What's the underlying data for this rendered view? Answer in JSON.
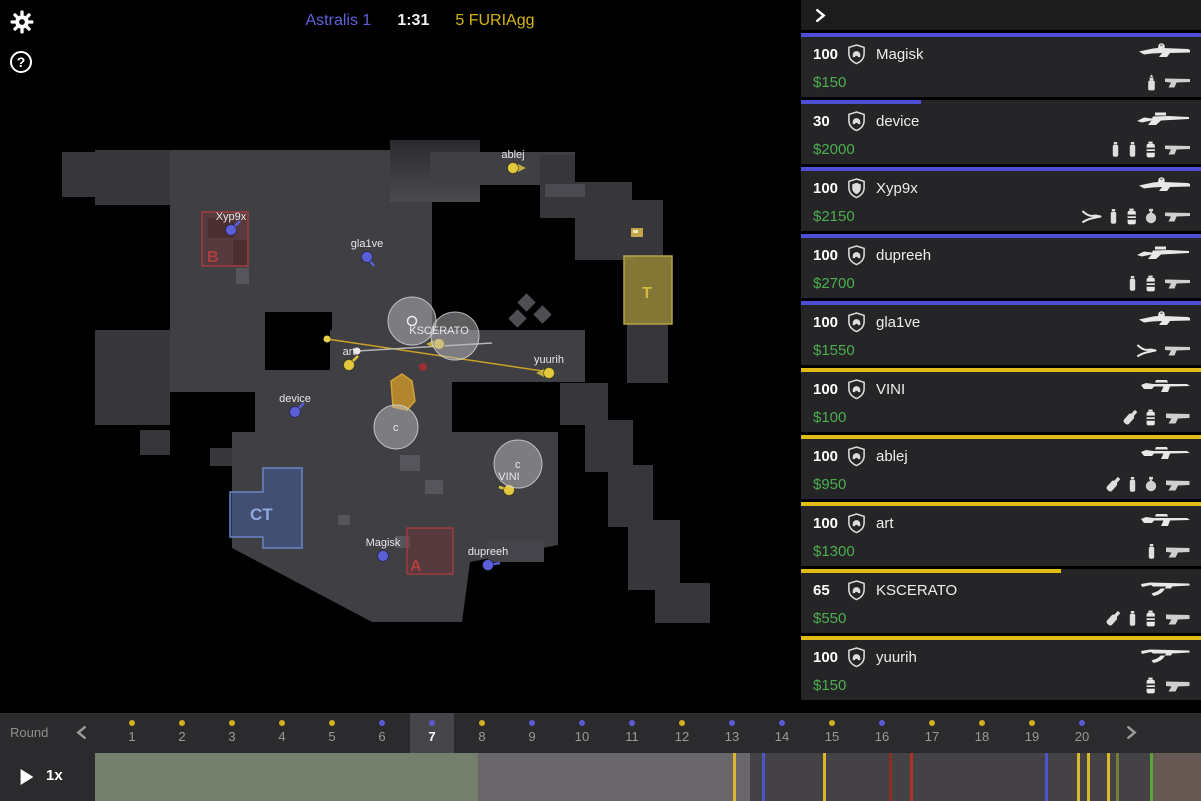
{
  "topbar": {
    "help_glyph": "?"
  },
  "scoreboard": {
    "team1": "Astralis",
    "team1_score": "1",
    "clock": "1:31",
    "team2_score": "5",
    "team2": "FURIAgg"
  },
  "colors": {
    "ct": "#4d4fd4",
    "t": "#e0bd16",
    "map_ct": "#5a5fd8",
    "map_t": "#e3c83f",
    "money": "#4cae4f",
    "dot_ct": "#5b5bd8",
    "dot_t": "#d4af1f"
  },
  "sidebar": {
    "players": [
      {
        "hp": "100",
        "name": "Magisk",
        "money": "$150",
        "team": "ct",
        "armor": "helmet",
        "primary": "aug",
        "items": [
          "incendiary",
          "usp"
        ]
      },
      {
        "hp": "30",
        "name": "device",
        "money": "$2000",
        "team": "ct",
        "armor": "helmet",
        "primary": "awp",
        "items": [
          "flash",
          "flash",
          "smoke",
          "usp"
        ]
      },
      {
        "hp": "100",
        "name": "Xyp9x",
        "money": "$2150",
        "team": "ct",
        "armor": "kevlar",
        "primary": "aug",
        "items": [
          "defuse",
          "flash",
          "smoke",
          "he",
          "usp"
        ]
      },
      {
        "hp": "100",
        "name": "dupreeh",
        "money": "$2700",
        "team": "ct",
        "armor": "helmet",
        "primary": "awp",
        "items": [
          "flash",
          "smoke",
          "usp"
        ]
      },
      {
        "hp": "100",
        "name": "gla1ve",
        "money": "$1550",
        "team": "ct",
        "armor": "helmet",
        "primary": "aug",
        "items": [
          "defuse",
          "usp"
        ]
      },
      {
        "hp": "100",
        "name": "VINI",
        "money": "$100",
        "team": "t",
        "armor": "helmet",
        "primary": "galil",
        "items": [
          "molotov",
          "smoke",
          "glock"
        ]
      },
      {
        "hp": "100",
        "name": "ablej",
        "money": "$950",
        "team": "t",
        "armor": "helmet",
        "primary": "galil",
        "items": [
          "molotov",
          "flash",
          "he",
          "glock"
        ]
      },
      {
        "hp": "100",
        "name": "art",
        "money": "$1300",
        "team": "t",
        "armor": "helmet",
        "primary": "galil",
        "items": [
          "flash",
          "glock"
        ]
      },
      {
        "hp": "65",
        "name": "KSCERATO",
        "money": "$550",
        "team": "t",
        "armor": "helmet",
        "primary": "ak47",
        "items": [
          "molotov",
          "flash",
          "smoke",
          "glock"
        ]
      },
      {
        "hp": "100",
        "name": "yuurih",
        "money": "$150",
        "team": "t",
        "armor": "helmet",
        "primary": "ak47",
        "items": [
          "smoke",
          "glock"
        ]
      }
    ]
  },
  "map": {
    "zones": [
      {
        "id": "b-site",
        "label": "B",
        "shape": "rect",
        "x": 202,
        "y": 212,
        "w": 46,
        "h": 54,
        "label_x": 207,
        "label_y": 262,
        "label_color": "#b04040"
      },
      {
        "id": "a-site",
        "label": "A",
        "shape": "rect",
        "x": 407,
        "y": 528,
        "w": 46,
        "h": 46,
        "label_x": 410,
        "label_y": 571,
        "label_color": "#b04040"
      },
      {
        "id": "ct-spawn",
        "label": "CT",
        "shape": "poly",
        "pts": "230,492 263,492 263,468 302,468 302,548 263,548 263,537 230,537",
        "label_x": 250,
        "label_y": 520,
        "label_color": "#8fa8e0"
      },
      {
        "id": "t-spawn",
        "label": "T",
        "shape": "rect",
        "x": 624,
        "y": 256,
        "w": 48,
        "h": 68,
        "label_x": 642,
        "label_y": 298,
        "label_color": "#d2ba45"
      }
    ],
    "players": [
      {
        "name": "ablej",
        "team": "t",
        "x": 513,
        "y": 168,
        "dir": "cone-right"
      },
      {
        "name": "Xyp9x",
        "team": "ct",
        "x": 231,
        "y": 230,
        "dir": "line-ur"
      },
      {
        "name": "gla1ve",
        "team": "ct",
        "x": 367,
        "y": 257,
        "dir": "line-dr"
      },
      {
        "name": "device",
        "team": "ct",
        "x": 295,
        "y": 412,
        "dir": "line-ur"
      },
      {
        "name": "art",
        "team": "t",
        "x": 349,
        "y": 365,
        "dir": "line-ur"
      },
      {
        "name": "KSCERATO",
        "team": "t",
        "x": 439,
        "y": 344,
        "dir": "cone-left"
      },
      {
        "name": "yuurih",
        "team": "t",
        "x": 549,
        "y": 373,
        "dir": "cone-left"
      },
      {
        "name": "VINI",
        "team": "t",
        "x": 509,
        "y": 490,
        "dir": "line-l"
      },
      {
        "name": "Magisk",
        "team": "ct",
        "x": 383,
        "y": 556,
        "dir": "none"
      },
      {
        "name": "dupreeh",
        "team": "ct",
        "x": 488,
        "y": 565,
        "dir": "line-r"
      }
    ],
    "smokes": [
      {
        "x": 412,
        "y": 321,
        "r": 24,
        "glyph": "o"
      },
      {
        "x": 455,
        "y": 336,
        "r": 24,
        "glyph": ""
      },
      {
        "x": 396,
        "y": 427,
        "r": 22,
        "glyph": "c"
      },
      {
        "x": 518,
        "y": 464,
        "r": 24,
        "glyph": "c"
      }
    ],
    "tracers": [
      {
        "x1": 327,
        "y1": 339,
        "x2": 549,
        "y2": 372,
        "color": "#c9a227",
        "dot": "#e7cf4a"
      },
      {
        "x1": 357,
        "y1": 351,
        "x2": 492,
        "y2": 343,
        "color": "#b5b5b5",
        "dot": "#e8e8e8"
      }
    ],
    "fire": {
      "pts": "391,381 402,374 412,381 415,401 407,410 393,407"
    },
    "red_dot": {
      "x": 423,
      "y": 367
    },
    "bomb": {
      "x": 631,
      "y": 228
    }
  },
  "timeline": {
    "label": "Round",
    "speed": "1x",
    "selected_round": 7,
    "rounds": [
      {
        "n": "1",
        "winner": "t"
      },
      {
        "n": "2",
        "winner": "t"
      },
      {
        "n": "3",
        "winner": "t"
      },
      {
        "n": "4",
        "winner": "t"
      },
      {
        "n": "5",
        "winner": "t"
      },
      {
        "n": "6",
        "winner": "ct"
      },
      {
        "n": "7",
        "winner": "ct"
      },
      {
        "n": "8",
        "winner": "t"
      },
      {
        "n": "9",
        "winner": "ct"
      },
      {
        "n": "10",
        "winner": "ct"
      },
      {
        "n": "11",
        "winner": "ct"
      },
      {
        "n": "12",
        "winner": "t"
      },
      {
        "n": "13",
        "winner": "ct"
      },
      {
        "n": "14",
        "winner": "ct"
      },
      {
        "n": "15",
        "winner": "t"
      },
      {
        "n": "16",
        "winner": "ct"
      },
      {
        "n": "17",
        "winner": "t"
      },
      {
        "n": "18",
        "winner": "t"
      },
      {
        "n": "19",
        "winner": "t"
      },
      {
        "n": "20",
        "winner": "ct"
      }
    ],
    "segments": [
      {
        "from": 95,
        "to": 478,
        "color": "#74806b"
      },
      {
        "from": 478,
        "to": 750,
        "color": "#6a676a"
      },
      {
        "from": 750,
        "to": 1152,
        "color": "#454245"
      },
      {
        "from": 1152,
        "to": 1201,
        "color": "#665852"
      }
    ],
    "events": [
      {
        "x": 733,
        "color": "#d9b829"
      },
      {
        "x": 762,
        "color": "#4a57cc"
      },
      {
        "x": 823,
        "color": "#d9b829"
      },
      {
        "x": 889,
        "color": "#8c2f22"
      },
      {
        "x": 910,
        "color": "#b03326"
      },
      {
        "x": 1045,
        "color": "#4a57cc"
      },
      {
        "x": 1077,
        "color": "#d9b829"
      },
      {
        "x": 1087,
        "color": "#d9b829"
      },
      {
        "x": 1107,
        "color": "#d9b829"
      },
      {
        "x": 1116,
        "color": "#6f7f3a"
      },
      {
        "x": 1150,
        "color": "#58a33a"
      }
    ]
  }
}
